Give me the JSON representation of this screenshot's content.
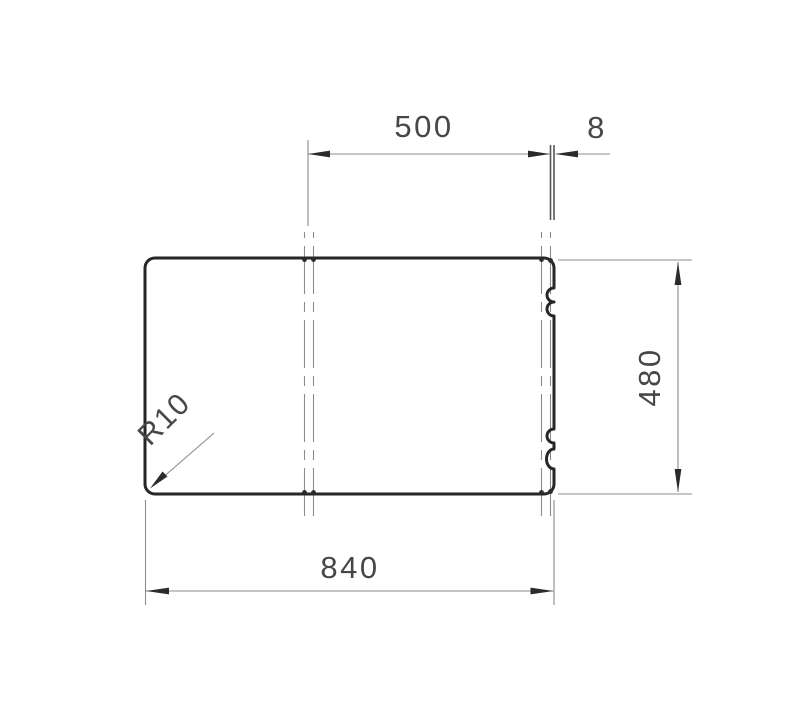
{
  "colors": {
    "outline": "#262626",
    "thin_line": "#8c8c8c",
    "ext_dark": "#555555",
    "arrow": "#2b2b2b",
    "text": "#474747",
    "background": "#ffffff"
  },
  "drawing": {
    "type": "technical-dimension-drawing",
    "labels": {
      "top_width": "500",
      "edge_offset": "8",
      "side_height": "480",
      "bottom_width": "840",
      "corner_radius": "R10"
    }
  }
}
